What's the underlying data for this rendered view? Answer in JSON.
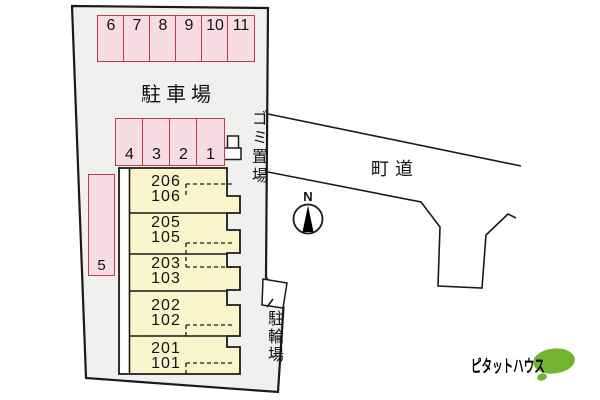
{
  "site_plan": {
    "parking_lot_label": "駐車場",
    "road_label": "町道",
    "garbage_area_label": "ゴミ置場",
    "bicycle_parking_label": "駐輪場",
    "compass_label": "N",
    "parking_top_row": [
      "6",
      "7",
      "8",
      "9",
      "10",
      "11"
    ],
    "parking_mid_row": [
      "4",
      "3",
      "2",
      "1"
    ],
    "parking_side_space": "5",
    "units": [
      {
        "upper": "206",
        "lower": "106"
      },
      {
        "upper": "205",
        "lower": "105"
      },
      {
        "upper": "203",
        "lower": "103"
      },
      {
        "upper": "202",
        "lower": "102"
      },
      {
        "upper": "201",
        "lower": "101"
      }
    ]
  },
  "logo": {
    "text": "ピタットハウス"
  },
  "icons": {
    "compass_needle": "north-arrow-black-triangle",
    "logo_mark": "green-speech-bubble-ellipse"
  },
  "colors": {
    "parking_fill": "#f8dce3",
    "parking_border": "#c03a4a",
    "unit_fill": "#fbf5cb",
    "plot_fill": "#f0f0ee",
    "line_color": "#1a1a1a",
    "logo_green": "#74b32e"
  }
}
